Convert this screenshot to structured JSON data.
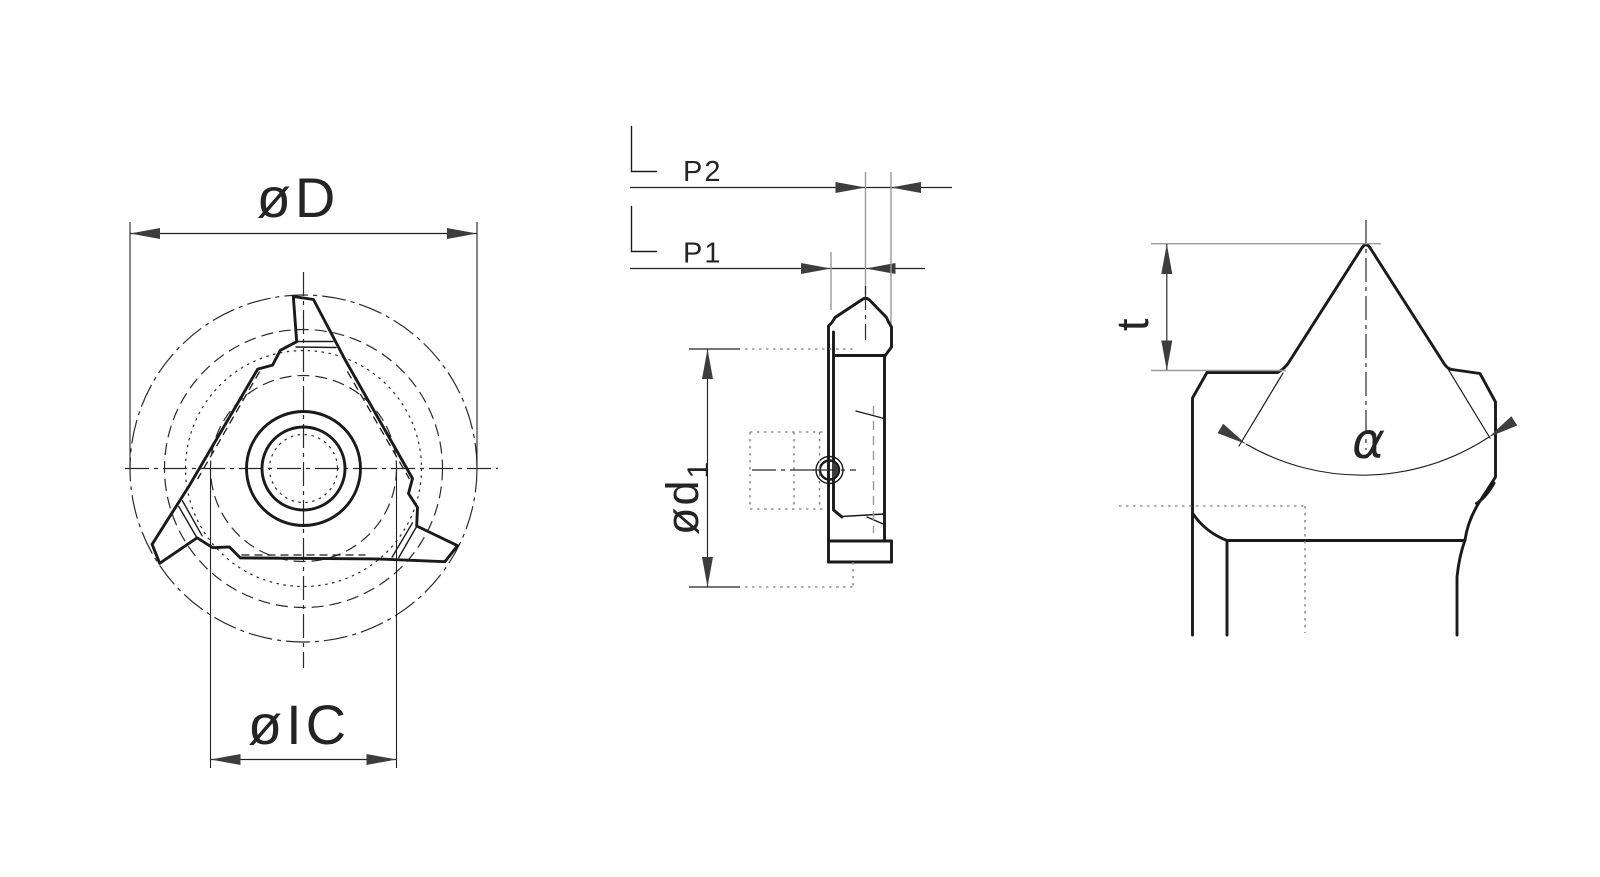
{
  "drawing": {
    "background_color": "#ffffff",
    "line_color": "#1a1a1a",
    "dimension_color": "#222222",
    "construction_color": "#9a9a9a",
    "dotted_color": "#7f7f7f",
    "arrow_color": "#3d3d3d",
    "views": {
      "top": {
        "outer_diameter_label": "øD",
        "inscribed_circle_label": "øIC"
      },
      "side": {
        "pitch2_label": "P2",
        "pitch1_label": "P1",
        "bore_diameter_label": "ød",
        "bore_diameter_subscript": "1"
      },
      "detail": {
        "thread_depth_label": "t",
        "thread_angle_label": "α"
      }
    }
  }
}
